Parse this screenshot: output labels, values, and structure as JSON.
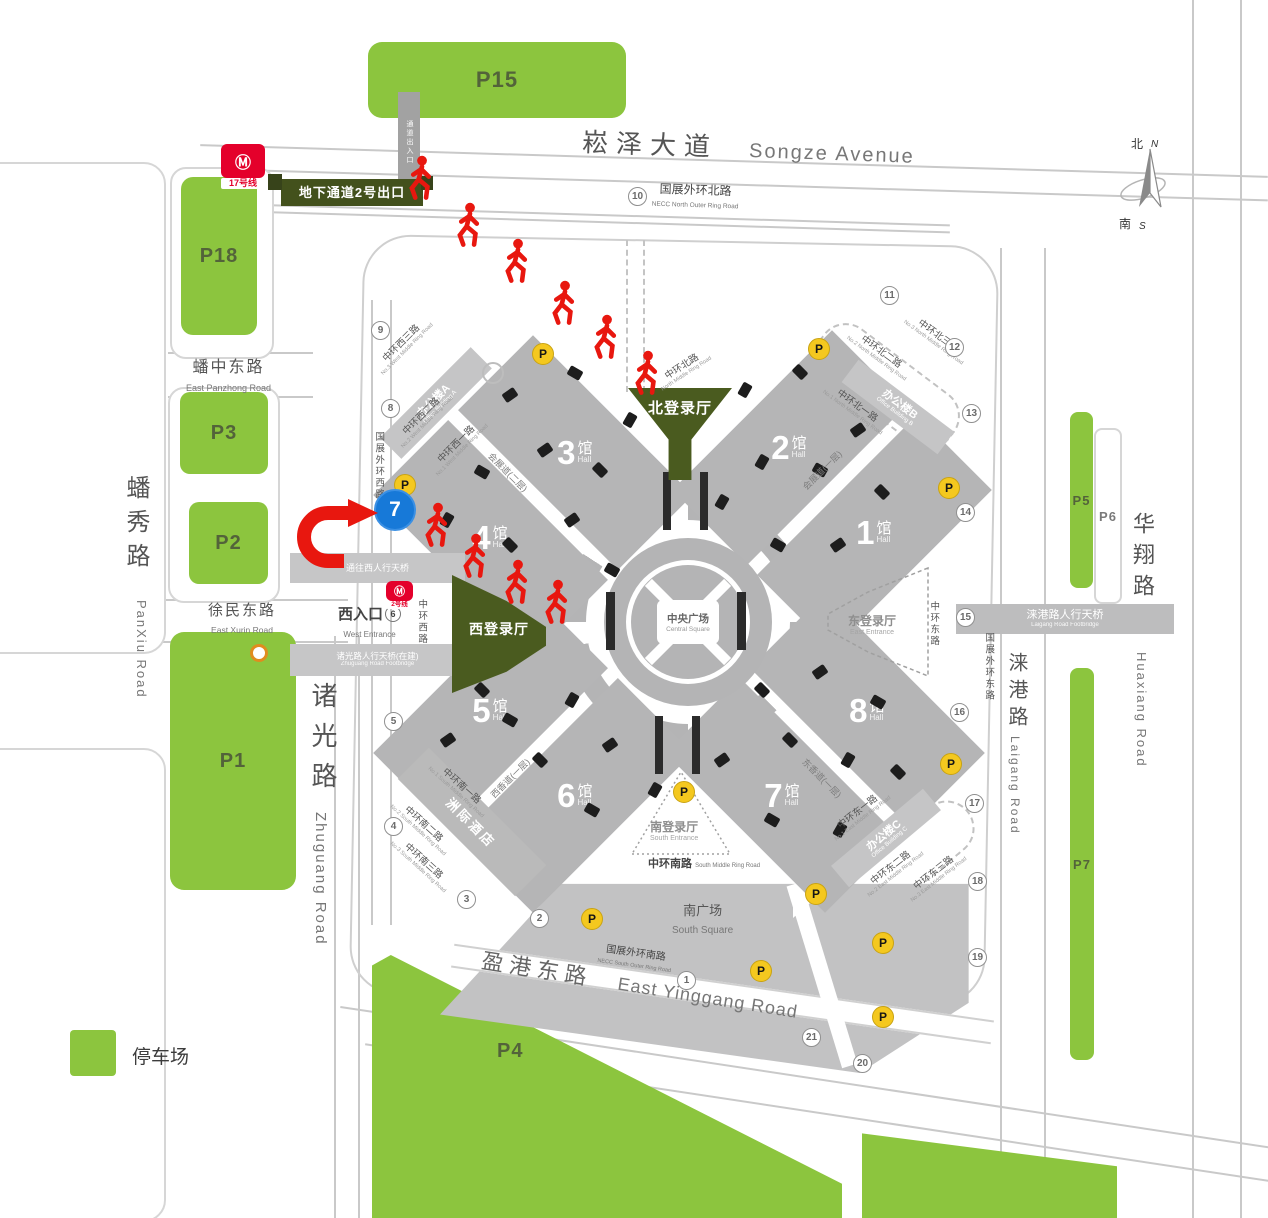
{
  "colors": {
    "parking_green": "#8cc53e",
    "entrance_green": "#4a5b1f",
    "route_red": "#e8170f",
    "gate_blue": "#1779d8",
    "parking_icon_yellow": "#f4c81f",
    "metro_red": "#e4002b"
  },
  "legend": {
    "label": "停车场"
  },
  "compass": {
    "north_zh": "北",
    "north_en": "N",
    "south_zh": "南",
    "south_en": "S"
  },
  "parking": {
    "P15": "P15",
    "P18": "P18",
    "P3": "P3",
    "P2": "P2",
    "P1": "P1",
    "P4": "P4",
    "P5": "P5",
    "P6": "P6",
    "P7": "P7"
  },
  "halls": {
    "h1": {
      "num": "1",
      "suffix": "馆",
      "en": "Hall"
    },
    "h2": {
      "num": "2",
      "suffix": "馆",
      "en": "Hall"
    },
    "h3": {
      "num": "3",
      "suffix": "馆",
      "en": "Hall"
    },
    "h4": {
      "num": "4",
      "suffix": "馆",
      "en": "Hall"
    },
    "h5": {
      "num": "5",
      "suffix": "馆",
      "en": "Hall"
    },
    "h6": {
      "num": "6",
      "suffix": "馆",
      "en": "Hall"
    },
    "h7": {
      "num": "7",
      "suffix": "馆",
      "en": "Hall"
    },
    "h8": {
      "num": "8",
      "suffix": "馆",
      "en": "Hall"
    }
  },
  "entrances": {
    "north": {
      "zh": "北登录厅"
    },
    "west": {
      "zh": "西登录厅"
    },
    "east": {
      "zh": "东登录厅",
      "en": "East Entrance"
    },
    "south": {
      "zh": "南登录厅",
      "en": "South Entrance"
    },
    "west_gate": {
      "zh": "西入口",
      "en": "West Entrance",
      "num": "6"
    }
  },
  "plaza": {
    "zh": "中央广场",
    "en": "Central Square"
  },
  "buildings": {
    "office_a": {
      "zh": "办公楼A",
      "en": "Office Building A"
    },
    "office_b": {
      "zh": "办公楼B",
      "en": "Office Building B"
    },
    "office_c": {
      "zh": "办公楼C",
      "en": "Office Building C"
    },
    "hotel": {
      "zh": "洲际酒店"
    },
    "south_square": {
      "zh": "南广场",
      "en": "South Square"
    }
  },
  "roads": {
    "songze": {
      "zh": "崧泽大道",
      "en": "Songze Avenue"
    },
    "necc_north": {
      "zh": "国展外环北路",
      "en": "NECC North Outer Ring Road"
    },
    "necc_south": {
      "zh": "国展外环南路",
      "en": "NECC South Outer Ring Road"
    },
    "panzhong": {
      "zh": "蟠中东路",
      "en": "East Panzhong Road"
    },
    "xumin": {
      "zh": "徐民东路",
      "en": "East Xurin Road"
    },
    "panxiu": {
      "zh": "蟠秀路",
      "en": "PanXiu Road"
    },
    "zhuguang": {
      "zh": "诸光路",
      "en": "Zhuguang Road"
    },
    "huaxiang": {
      "zh": "华翔路",
      "en": "Huaxiang Road"
    },
    "laigang": {
      "zh": "涞港路",
      "en": "Laigang Road"
    },
    "yinggang": {
      "zh": "盈港东路",
      "en": "East Yingg‌ang Road"
    },
    "ring_south": {
      "zh": "中环南路",
      "en": "South Middle Ring Road"
    }
  },
  "bridges": {
    "laigang_bridge": {
      "zh": "涞港路人行天桥",
      "en": "Laigang Road Footbridge"
    },
    "west_bridge": {
      "zh": "通往西人行天桥"
    },
    "zhuguang_bridge": {
      "zh": "诸光路人行天桥(在建)",
      "en": "Zhuguang Road Footbridge"
    },
    "passage": {
      "zh": "通道出入口"
    }
  },
  "route": {
    "exit_label": "地下通道2号出口",
    "metro_line17": "17号线",
    "metro_line2": "2号线",
    "gate_number": "7",
    "walkers": [
      [
        420,
        178
      ],
      [
        468,
        225
      ],
      [
        516,
        261
      ],
      [
        563,
        303
      ],
      [
        605,
        337
      ],
      [
        646,
        373
      ],
      [
        436,
        525
      ],
      [
        474,
        556
      ],
      [
        516,
        582
      ],
      [
        556,
        602
      ]
    ]
  },
  "ring_labels": [
    {
      "zh": "中环西三路",
      "en": "No.3 West Middle Ring Road",
      "x": 404,
      "y": 346,
      "r": -45
    },
    {
      "zh": "中环西二路",
      "en": "No.2 West Middle Ring Road",
      "x": 424,
      "y": 419,
      "r": -45
    },
    {
      "zh": "中环西一路",
      "en": "No.1 West Middle Ring Road",
      "x": 459,
      "y": 447,
      "r": -45
    },
    {
      "zh": "中环北路",
      "en": "North Middle Ring Road",
      "x": 684,
      "y": 370,
      "r": -33
    },
    {
      "zh": "中环北一路",
      "en": "No.1 North Middle Ring Road",
      "x": 855,
      "y": 409,
      "r": 36
    },
    {
      "zh": "中环北二路",
      "en": "No.2 North Middle Ring Road",
      "x": 879,
      "y": 355,
      "r": 36
    },
    {
      "zh": "中环北三路",
      "en": "No.3 North Middle Ring Road",
      "x": 936,
      "y": 339,
      "r": 36
    },
    {
      "zh": "中环西路",
      "x": 421,
      "y": 622,
      "r": 90
    },
    {
      "zh": "中环东路",
      "x": 933,
      "y": 624,
      "r": 90
    },
    {
      "zh": "国展外环西路",
      "x": 378,
      "y": 466,
      "r": 90
    },
    {
      "zh": "国展外环东路",
      "x": 988,
      "y": 667,
      "r": 90
    },
    {
      "zh": "中环东一路",
      "en": "No.1 East Middle Ring Road",
      "x": 860,
      "y": 815,
      "r": -38
    },
    {
      "zh": "中环东二路",
      "en": "No.2 East Middle Ring Road",
      "x": 893,
      "y": 871,
      "r": -38
    },
    {
      "zh": "中环东三路",
      "en": "No.3 East Middle Ring Road",
      "x": 936,
      "y": 876,
      "r": -38
    },
    {
      "zh": "中环南一路",
      "en": "No.1 South Middle Ring Road",
      "x": 459,
      "y": 789,
      "r": 42
    },
    {
      "zh": "中环南二路",
      "en": "No.2 South Middle Ring Road",
      "x": 421,
      "y": 827,
      "r": 42
    },
    {
      "zh": "中环南三路",
      "en": "No.3 South Middle Ring Road",
      "x": 421,
      "y": 864,
      "r": 42
    }
  ],
  "walkway_labels": [
    {
      "zh": "会展道(二层)",
      "x": 508,
      "y": 472,
      "r": 45
    },
    {
      "zh": "会展道(一层)",
      "x": 822,
      "y": 470,
      "r": -45
    },
    {
      "zh": "西香道(一层)",
      "x": 510,
      "y": 778,
      "r": -45
    },
    {
      "zh": "东香道(一层)",
      "x": 822,
      "y": 778,
      "r": 45
    }
  ],
  "markers": {
    "numbers": [
      {
        "n": "1",
        "x": 686,
        "y": 980
      },
      {
        "n": "2",
        "x": 539,
        "y": 918
      },
      {
        "n": "3",
        "x": 466,
        "y": 899
      },
      {
        "n": "4",
        "x": 393,
        "y": 826
      },
      {
        "n": "5",
        "x": 393,
        "y": 721
      },
      {
        "n": "8",
        "x": 390,
        "y": 408
      },
      {
        "n": "9",
        "x": 380,
        "y": 330
      },
      {
        "n": "10",
        "x": 637,
        "y": 196
      },
      {
        "n": "11",
        "x": 889,
        "y": 295
      },
      {
        "n": "12",
        "x": 954,
        "y": 347
      },
      {
        "n": "13",
        "x": 971,
        "y": 413
      },
      {
        "n": "14",
        "x": 965,
        "y": 512
      },
      {
        "n": "15",
        "x": 965,
        "y": 617
      },
      {
        "n": "16",
        "x": 959,
        "y": 712
      },
      {
        "n": "17",
        "x": 974,
        "y": 803
      },
      {
        "n": "18",
        "x": 977,
        "y": 881
      },
      {
        "n": "19",
        "x": 977,
        "y": 957
      },
      {
        "n": "20",
        "x": 862,
        "y": 1063
      },
      {
        "n": "21",
        "x": 811,
        "y": 1037
      }
    ],
    "parking_icons": [
      [
        542,
        353
      ],
      [
        818,
        348
      ],
      [
        404,
        484
      ],
      [
        948,
        487
      ],
      [
        950,
        763
      ],
      [
        815,
        893
      ],
      [
        683,
        791
      ],
      [
        591,
        918
      ],
      [
        760,
        970
      ],
      [
        882,
        942
      ],
      [
        882,
        1016
      ]
    ],
    "docks": [
      [
        510,
        395
      ],
      [
        575,
        373
      ],
      [
        630,
        420
      ],
      [
        600,
        470
      ],
      [
        545,
        450
      ],
      [
        482,
        472
      ],
      [
        447,
        520
      ],
      [
        510,
        545
      ],
      [
        572,
        520
      ],
      [
        612,
        570
      ],
      [
        745,
        390
      ],
      [
        800,
        372
      ],
      [
        858,
        430
      ],
      [
        820,
        470
      ],
      [
        762,
        462
      ],
      [
        882,
        492
      ],
      [
        838,
        545
      ],
      [
        778,
        545
      ],
      [
        722,
        502
      ],
      [
        482,
        690
      ],
      [
        448,
        740
      ],
      [
        510,
        720
      ],
      [
        572,
        700
      ],
      [
        540,
        760
      ],
      [
        610,
        745
      ],
      [
        592,
        810
      ],
      [
        655,
        790
      ],
      [
        762,
        690
      ],
      [
        820,
        672
      ],
      [
        878,
        702
      ],
      [
        848,
        760
      ],
      [
        790,
        740
      ],
      [
        722,
        760
      ],
      [
        772,
        820
      ],
      [
        840,
        830
      ],
      [
        898,
        772
      ]
    ]
  }
}
